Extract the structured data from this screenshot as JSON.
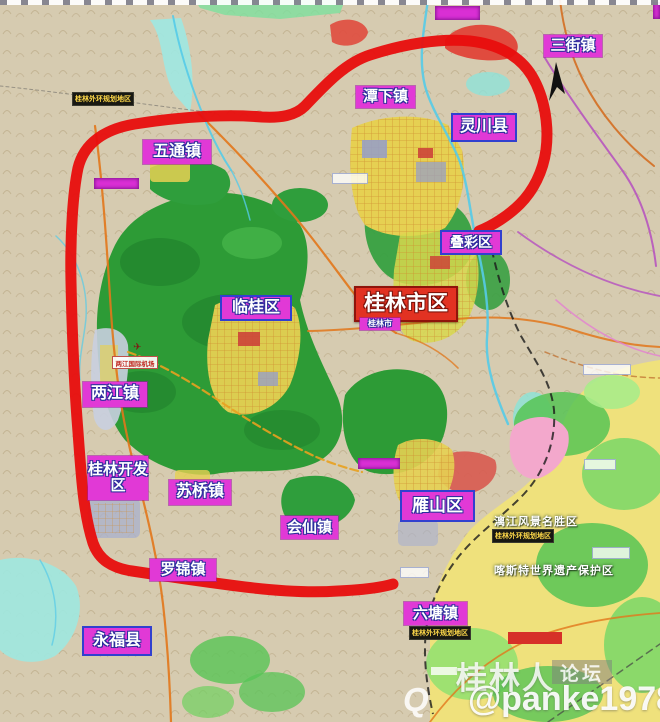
{
  "region_labels": [
    {
      "name": "sanjie-town",
      "text": "三街镇"
    },
    {
      "name": "tanxia-town",
      "text": "潭下镇"
    },
    {
      "name": "lingchuan-county",
      "text": "灵川县"
    },
    {
      "name": "wutong-town",
      "text": "五通镇"
    },
    {
      "name": "diecai-district",
      "text": "叠彩区"
    },
    {
      "name": "lingui-district",
      "text": "临桂区"
    },
    {
      "name": "guilin-city-area",
      "text": "桂林市区"
    },
    {
      "name": "guilin-city-small",
      "text": "桂林市"
    },
    {
      "name": "liangjiang-town",
      "text": "两江镇"
    },
    {
      "name": "guilin-dev-zone",
      "text": "桂林开发区"
    },
    {
      "name": "suqiao-town",
      "text": "苏桥镇"
    },
    {
      "name": "huixian-town",
      "text": "会仙镇"
    },
    {
      "name": "yanshan-district",
      "text": "雁山区"
    },
    {
      "name": "luojin-town",
      "text": "罗锦镇"
    },
    {
      "name": "yongfu-county",
      "text": "永福县"
    },
    {
      "name": "liutang-town",
      "text": "六塘镇"
    }
  ],
  "annotations": {
    "ring_note": "桂林外环规划地区",
    "lijiang_scenic": "漓江风景名胜区",
    "karst_heritage": "喀斯特世界遗产保护区",
    "airport": "两江国际机场"
  },
  "watermark": {
    "site_name": "桂林人",
    "forum": "论坛",
    "handle": "@panke1978",
    "logo_letter": "Q"
  },
  "colors": {
    "ring_road": "#e80d0d",
    "label_magenta": "#e139d6",
    "label_city_red": "#e23222",
    "note_bg": "#181812",
    "note_text": "#ffd94a",
    "forest": "#2d9b36",
    "farmland": "#efe17c",
    "water": "#55cbe8"
  }
}
